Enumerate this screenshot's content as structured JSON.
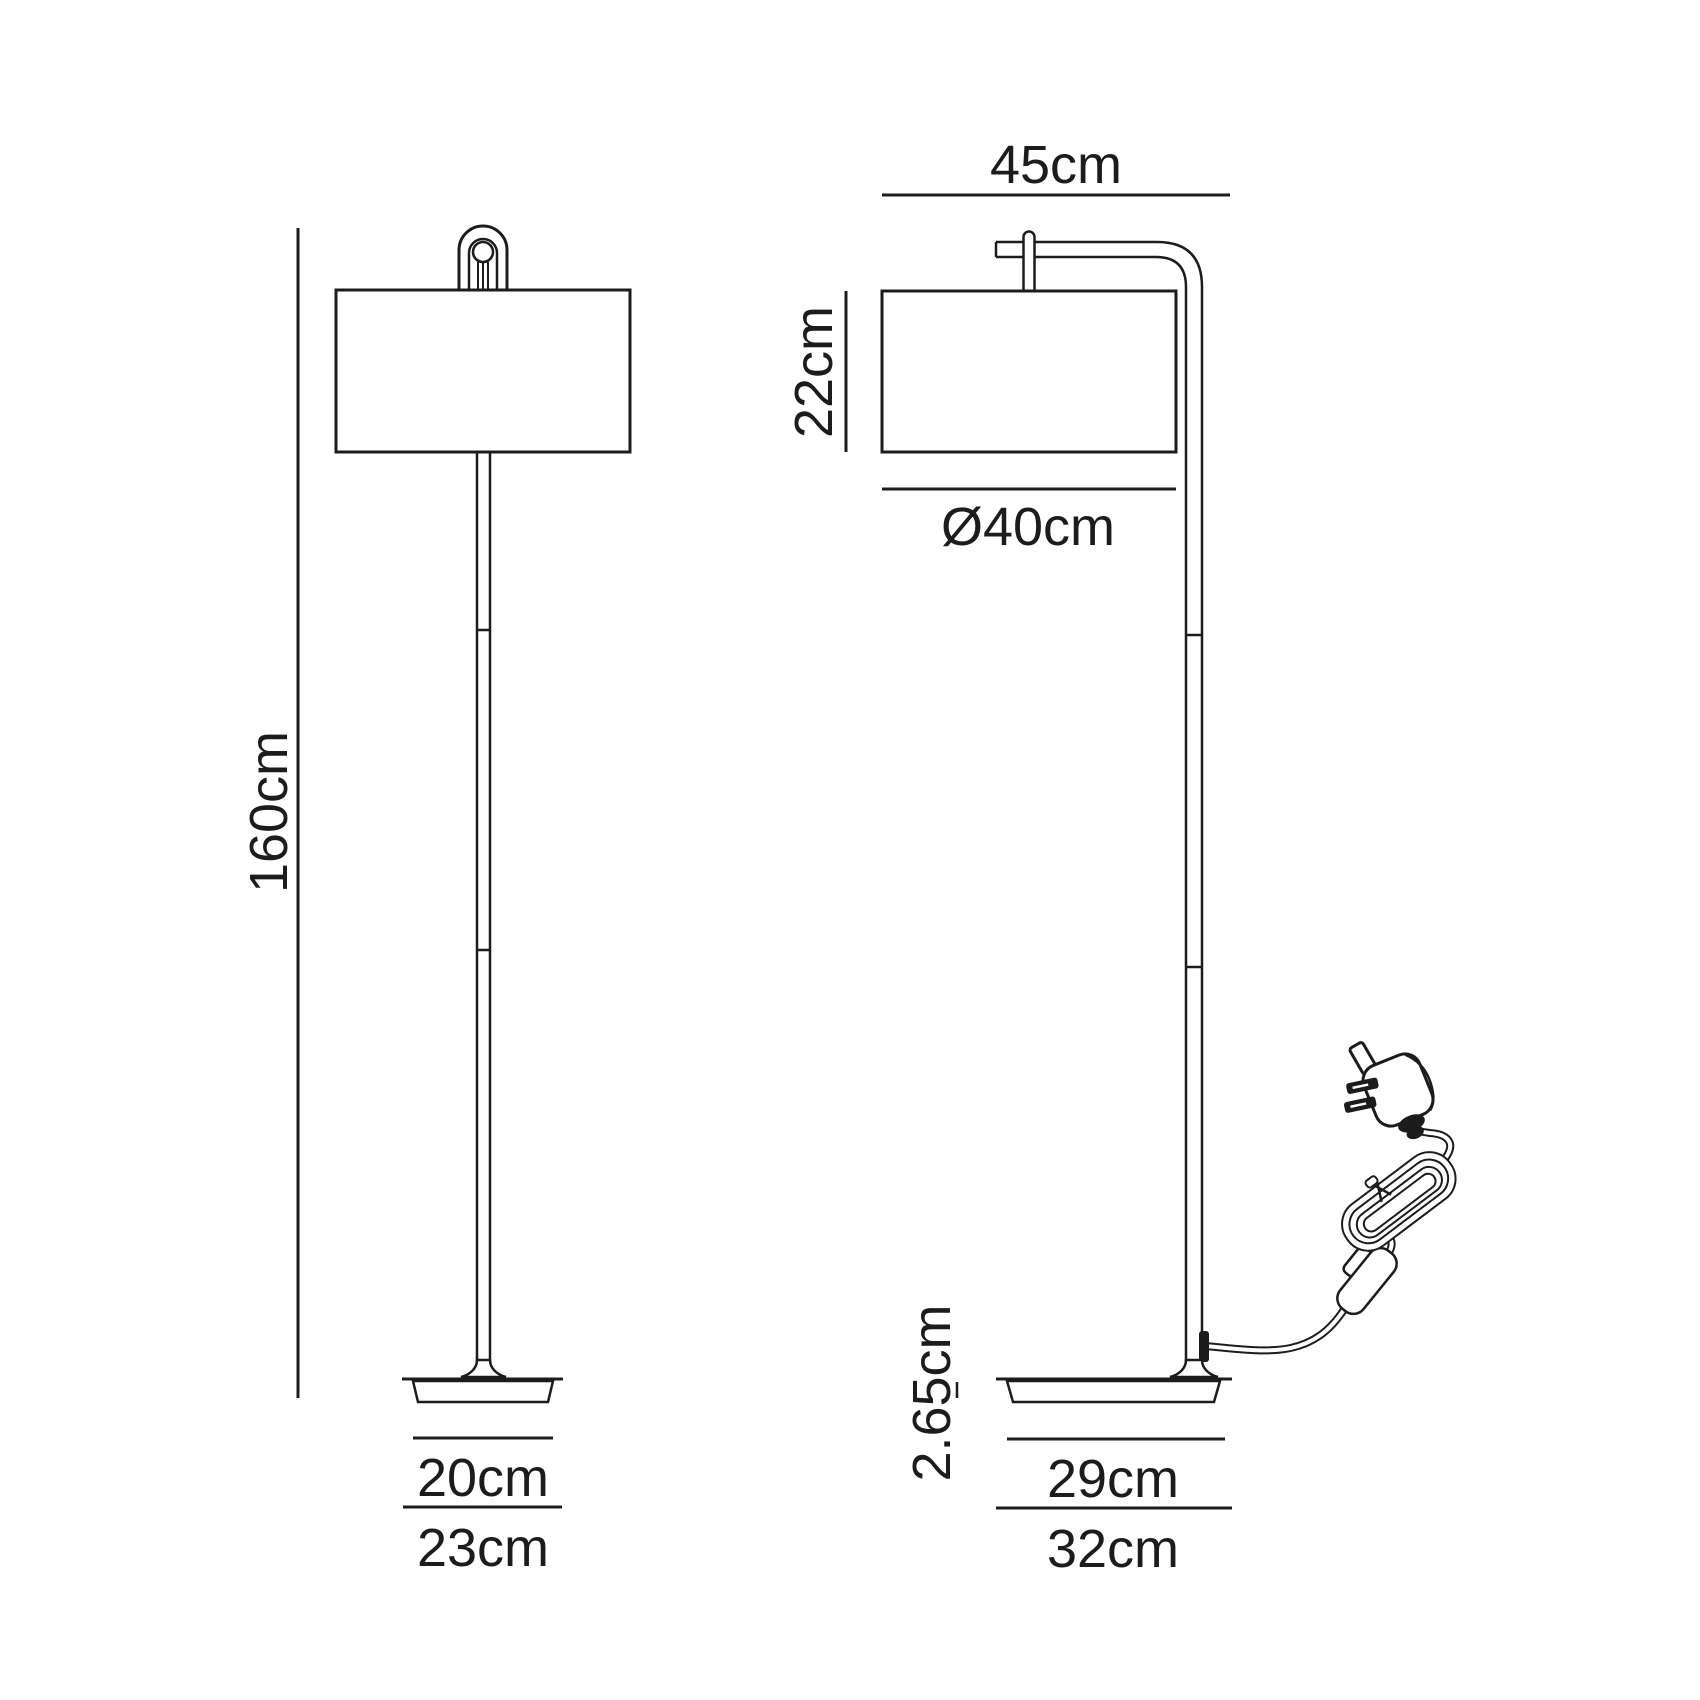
{
  "colors": {
    "line": "#1c1c1c",
    "background": "#ffffff"
  },
  "front_view": {
    "height_label": "160cm",
    "base_top_width_label": "20cm",
    "base_bottom_width_label": "23cm"
  },
  "side_view": {
    "depth_label": "45cm",
    "shade_height_label": "22cm",
    "shade_diameter_label": "Ø40cm",
    "base_thickness_label": "2.65cm",
    "base_top_depth_label": "29cm",
    "base_bottom_depth_label": "32cm"
  }
}
